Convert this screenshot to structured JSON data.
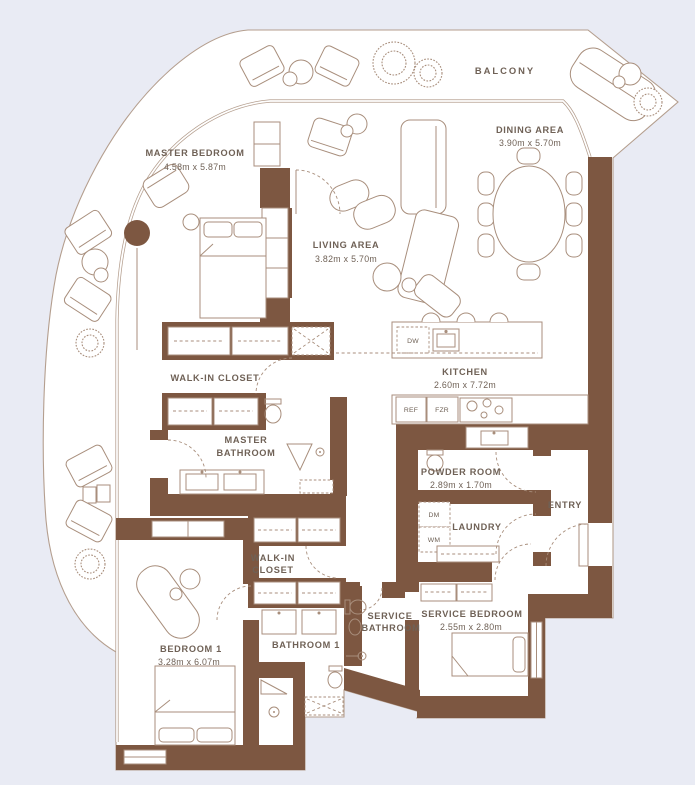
{
  "colors": {
    "background": "#e9ebf4",
    "floor": "#ffffff",
    "wall": "#7d5741",
    "line": "#a88e7c",
    "glass": "#b49e8e",
    "text": "#6f6156"
  },
  "plan": {
    "balcony_label": "BALCONY",
    "rooms": {
      "master_bedroom": {
        "name": "MASTER BEDROOM",
        "dims": "4.58m x 5.87m"
      },
      "living_area": {
        "name": "LIVING AREA",
        "dims": "3.82m x 5.70m"
      },
      "dining_area": {
        "name": "DINING AREA",
        "dims": "3.90m x 5.70m"
      },
      "kitchen": {
        "name": "KITCHEN",
        "dims": "2.60m x 7.72m"
      },
      "walk_in_closet_1": {
        "name": "WALK-IN CLOSET"
      },
      "master_bathroom": {
        "line1": "MASTER",
        "line2": "BATHROOM"
      },
      "powder_room": {
        "name": "POWDER ROOM",
        "dims": "2.89m x 1.70m"
      },
      "entry": {
        "name": "ENTRY"
      },
      "laundry": {
        "name": "LAUNDRY"
      },
      "walk_in_closet_2": {
        "line1": "WALK-IN",
        "line2": "CLOSET"
      },
      "service_bathroom": {
        "line1": "SERVICE",
        "line2": "BATHROOM"
      },
      "service_bedroom": {
        "name": "SERVICE BEDROOM",
        "dims": "2.55m x 2.80m"
      },
      "bedroom_1": {
        "name": "BEDROOM 1",
        "dims": "3.28m x 6.07m"
      },
      "bathroom_1": {
        "name": "BATHROOM 1"
      }
    },
    "appliances": {
      "dw": "DW",
      "ref": "REF",
      "fzr": "FZR",
      "dm": "DM",
      "wm": "WM"
    }
  }
}
